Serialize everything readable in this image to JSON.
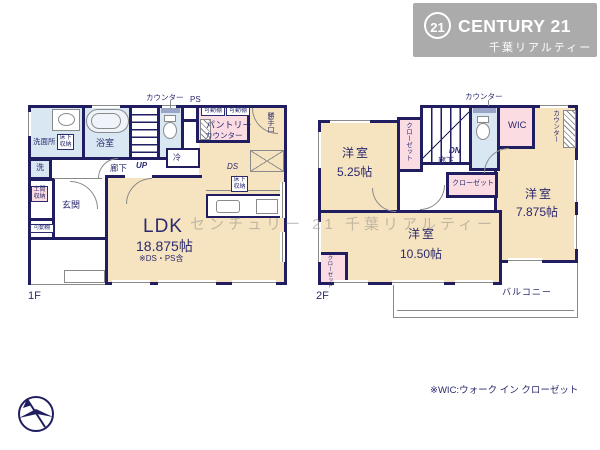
{
  "colors": {
    "wall": "#201e60",
    "label": "#2a2a6e",
    "beige": "#f6e3c0",
    "pink": "#fadce2",
    "blue": "#d9e7f3",
    "gray": "#ababab",
    "thin": "#8a8a8a"
  },
  "logo": {
    "badge": "21",
    "brand": "CENTURY 21",
    "subtitle": "千葉リアルティー"
  },
  "watermark": "センチュリー 21 千葉リアルティー",
  "note": "※WIC:ウォーク イン クローゼット",
  "f1": {
    "floor_label": "1F",
    "counter": "カウンター",
    "ps": "PS",
    "washroom": "洗面所",
    "underfloor1": "床下収納",
    "washer": "洗",
    "bath": "浴室",
    "up": "UP",
    "hall": "廊下",
    "shelf1": "可動棚",
    "shelf2": "可動棚",
    "pantry": "パントリー",
    "pantry_counter": "カウンター",
    "backdoor": "勝手口",
    "fridge": "冷",
    "ds": "DS",
    "underfloor2": "床下収納",
    "doma": "土間収納",
    "genkan": "玄関",
    "shelf3": "可動棚",
    "ldk": "LDK",
    "ldk_area": "18.875帖",
    "ldk_note": "※DS・PS含"
  },
  "f2": {
    "floor_label": "2F",
    "counter_top": "カウンター",
    "dn": "DN",
    "hall": "廊下",
    "wic": "WIC",
    "counter_right": "カウンター",
    "room1": "洋室",
    "room1_area": "5.25帖",
    "closet1": "クローゼット",
    "closet2": "クローゼット",
    "room2": "洋室",
    "room2_area": "7.875帖",
    "room3": "洋室",
    "room3_area": "10.50帖",
    "closet3": "クローゼット",
    "balcony": "バルコニー"
  }
}
